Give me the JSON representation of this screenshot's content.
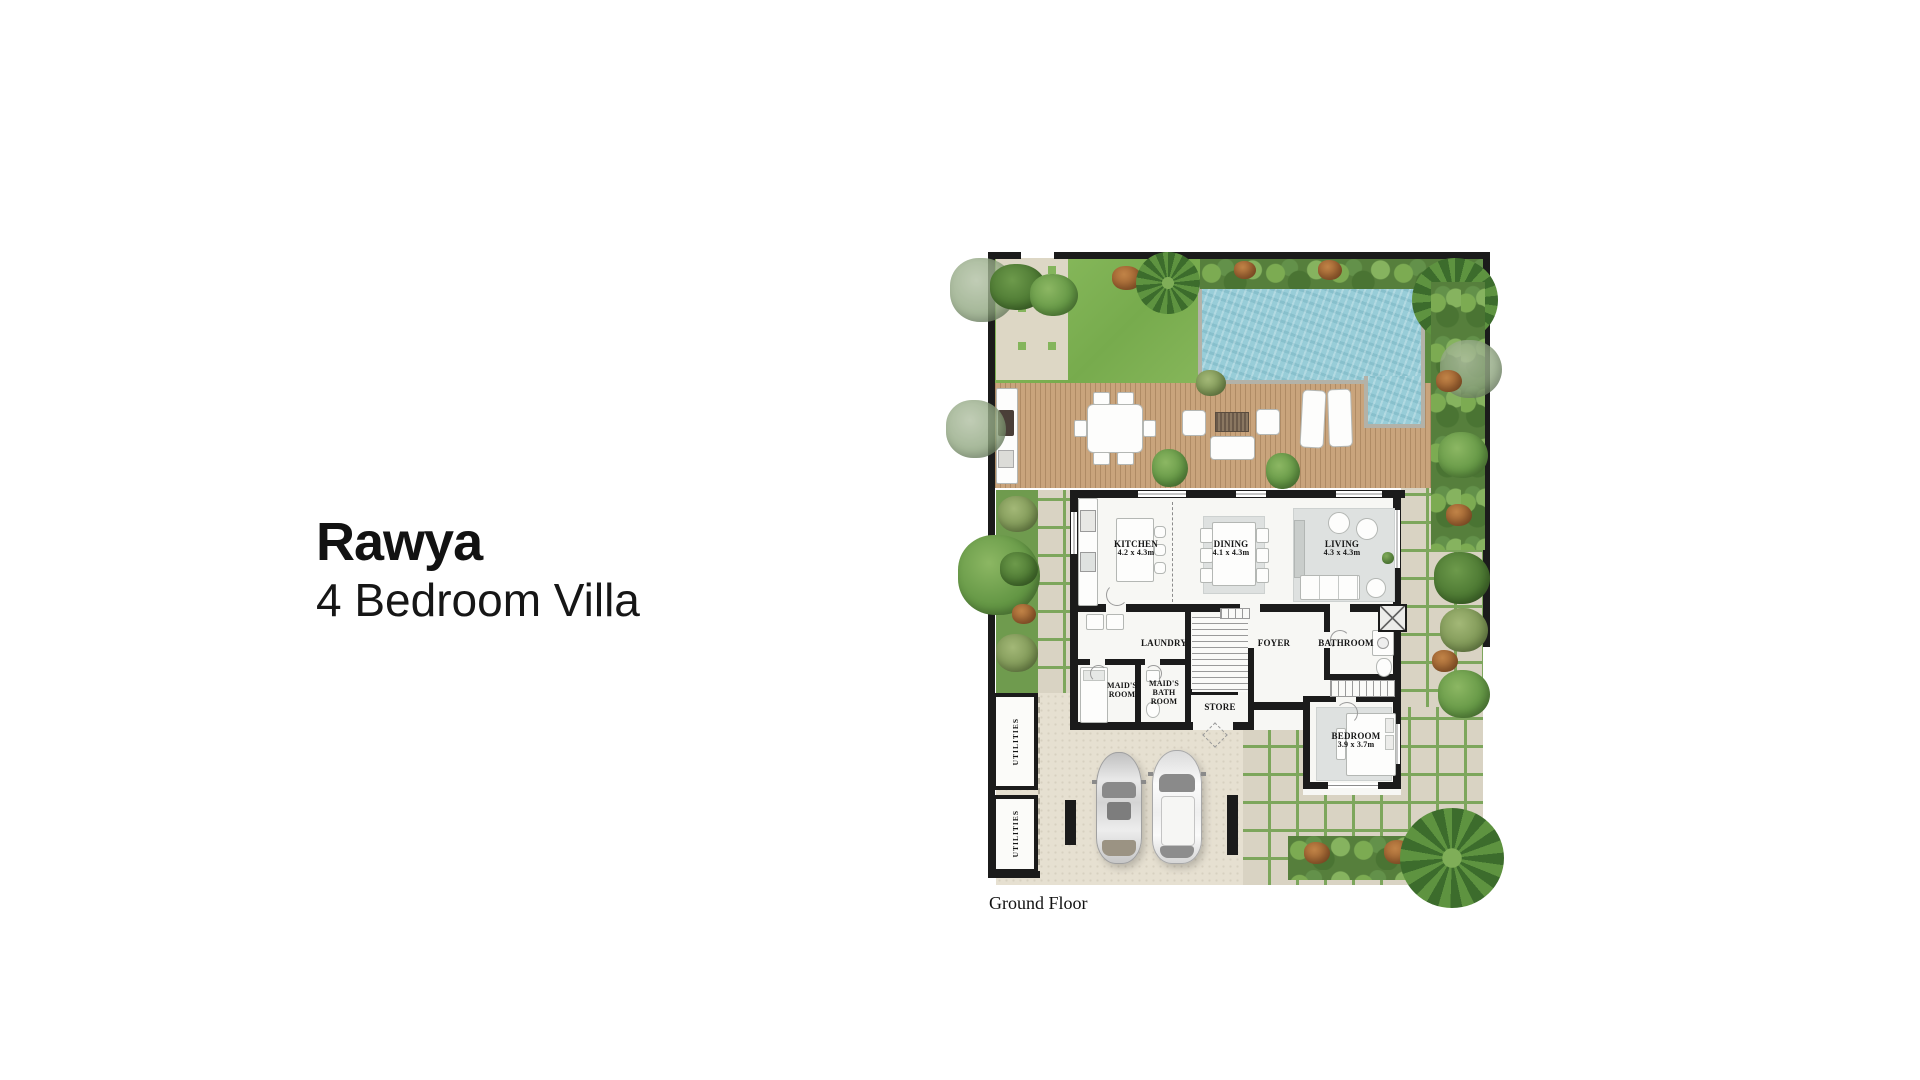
{
  "page": {
    "title": "Rawya",
    "subtitle": "4 Bedroom Villa",
    "floor_label": "Ground Floor"
  },
  "rooms": {
    "kitchen": {
      "name": "KITCHEN",
      "dims": "4.2 x 4.3m"
    },
    "dining": {
      "name": "DINING",
      "dims": "4.1 x 4.3m"
    },
    "living": {
      "name": "LIVING",
      "dims": "4.3 x 4.3m"
    },
    "laundry": {
      "name": "LAUNDRY"
    },
    "foyer": {
      "name": "FOYER"
    },
    "bathroom": {
      "name": "BATHROOM"
    },
    "maids_room": {
      "name": "MAID'S ROOM"
    },
    "maids_bath": {
      "name": "MAID'S BATH ROOM"
    },
    "store": {
      "name": "STORE"
    },
    "bedroom": {
      "name": "BEDROOM",
      "dims": "3.9 x 3.7m"
    },
    "utilities_top": {
      "name": "UTILITIES"
    },
    "utilities_bottom": {
      "name": "UTILITIES"
    }
  },
  "colors": {
    "lawn": "#7fb054",
    "pool_water": "#98cdd8",
    "wood_deck": "#c9a47c",
    "walls": "#1b1b1b",
    "paving_tile": "#d9d3c3",
    "paving_joint": "#7da65c",
    "driveway": "#e6e0d1",
    "vegetation": "#639644",
    "text": "#121212"
  }
}
